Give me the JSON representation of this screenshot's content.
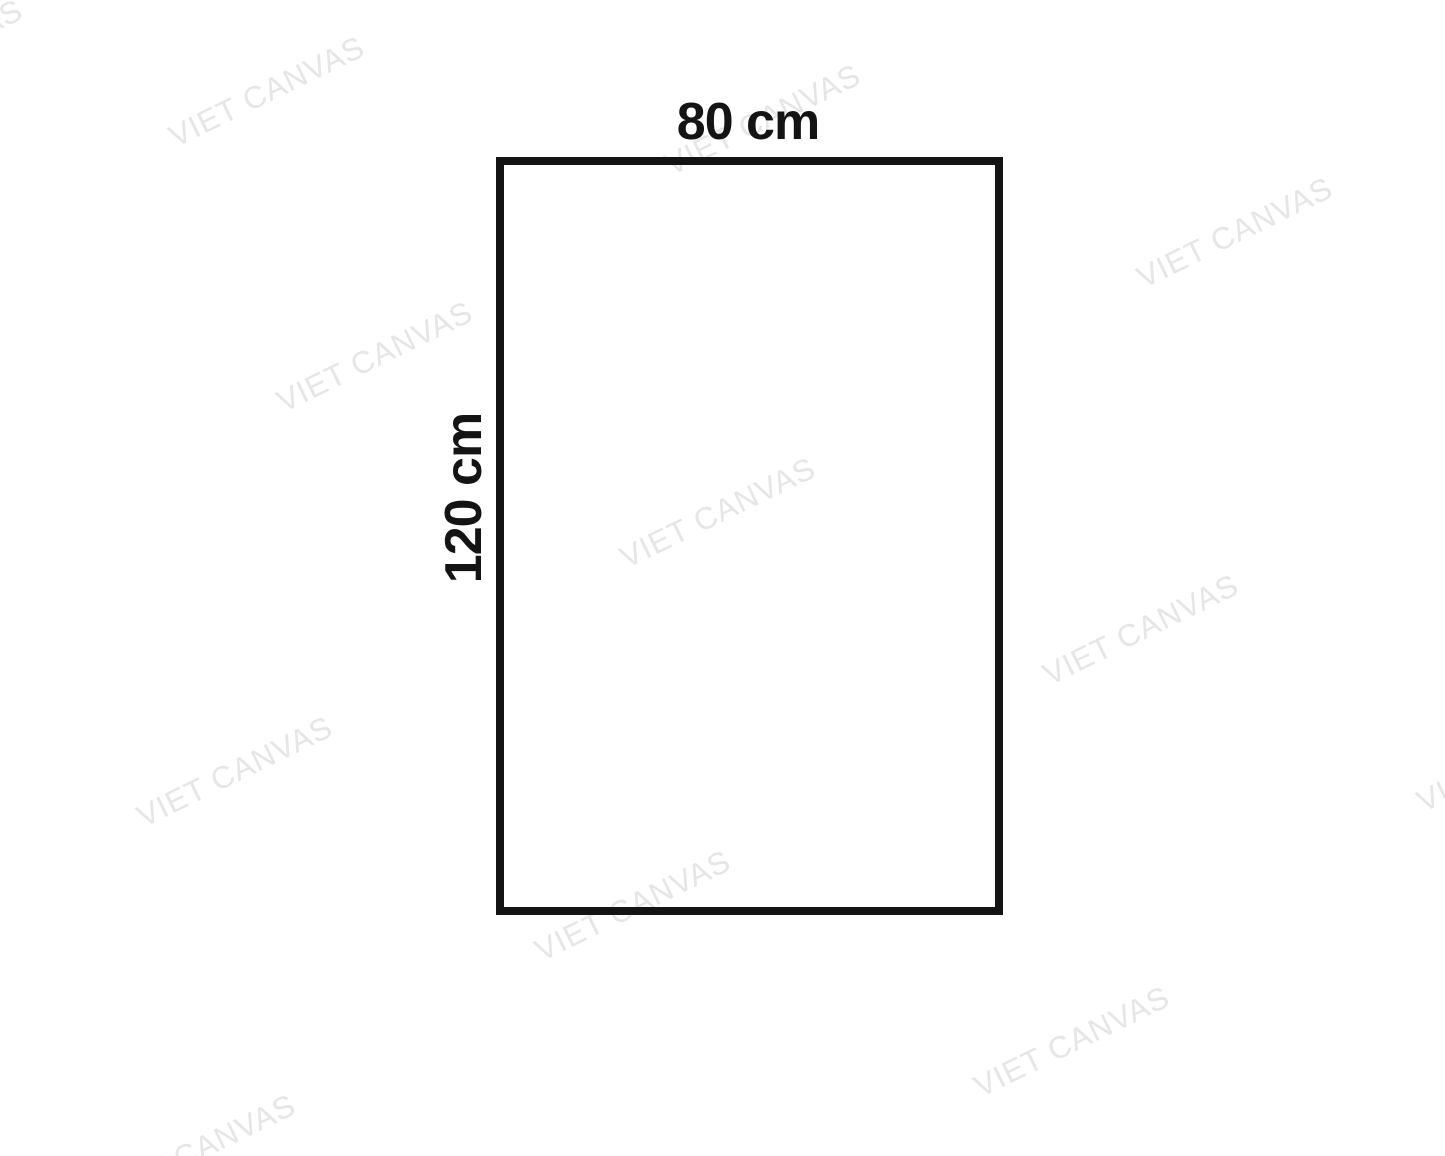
{
  "diagram": {
    "shape": "rectangle",
    "width_label": "80 cm",
    "height_label": "120 cm"
  },
  "watermark": {
    "text": "VIET CANVAS"
  },
  "colors": {
    "background": "#ffffff",
    "ink": "#141414",
    "watermark": "#e7e5e5"
  }
}
